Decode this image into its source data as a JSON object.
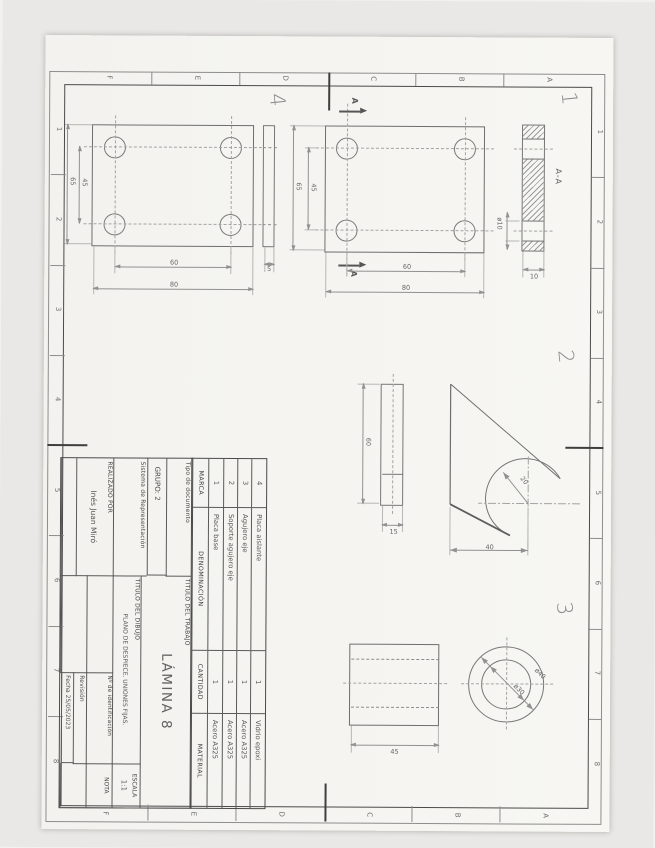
{
  "sheet": {
    "grid": {
      "numbers": [
        "1",
        "2",
        "3",
        "4",
        "5",
        "6",
        "7",
        "8"
      ],
      "letters": [
        "A",
        "B",
        "C",
        "D",
        "E",
        "F"
      ]
    }
  },
  "views": {
    "part1": {
      "label": "1",
      "section_title": "A-A",
      "cut_letter": "A",
      "dim_hole": "ø10",
      "dim_thickness": "10",
      "dim_holes_v": "60",
      "dim_height": "80",
      "dim_holes_h": "45",
      "dim_width": "65"
    },
    "part2": {
      "label": "2",
      "dim_radius": "20",
      "dim_center_height": "40",
      "dim_length": "60",
      "dim_thickness": "15"
    },
    "part3": {
      "label": "3",
      "dim_outer": "ø40",
      "dim_inner": "ø30",
      "dim_length": "45"
    },
    "part4": {
      "label": "4",
      "dim_thickness": "5",
      "dim_holes_v": "60",
      "dim_height": "80",
      "dim_holes_h": "45",
      "dim_width": "65"
    }
  },
  "parts_table": {
    "headers": {
      "marca": "MARCA",
      "denominacion": "DENOMINACIÓN",
      "cantidad": "CANTIDAD",
      "material": "MATERIAL"
    },
    "rows": [
      {
        "marca": "4",
        "denominacion": "Placa aislante",
        "cantidad": "1",
        "material": "Vidrio epoxi"
      },
      {
        "marca": "3",
        "denominacion": "Agujero eje",
        "cantidad": "1",
        "material": "Acero A325"
      },
      {
        "marca": "2",
        "denominacion": "Soporte agujero eje",
        "cantidad": "1",
        "material": "Acero A325"
      },
      {
        "marca": "1",
        "denominacion": "Placa base",
        "cantidad": "1",
        "material": "Acero A325"
      }
    ]
  },
  "title_block": {
    "tipo_documento_label": "Tipo de documento",
    "grupo_label": "GRUPO:",
    "grupo_value": "2",
    "sistema_label": "Sistema de Representación",
    "realizado_label": "REALIZADO POR",
    "realizado_value": "Inés Juan Miró",
    "titulo_trabajo_label": "TITULO DEL TRABAJO",
    "titulo_trabajo_value": "LÁMINA 8",
    "titulo_dibujo_label": "TITULO DEL DIBUJO",
    "titulo_dibujo_value": "PLANO DE DESPIECE. UNIONES FIJAS.",
    "num_id_label": "Nº de identificación",
    "escala_label": "ESCALA",
    "escala_value": "1:1",
    "nota_label": "NOTA",
    "revision_label": "Revisión",
    "fecha_label": "Fecha",
    "fecha_value": "25/05/2023"
  },
  "colors": {
    "paper": "#f6f5f1",
    "scanner_bg": "#e9e8e6",
    "frame_line": "#4a4a4a",
    "pencil_line": "#7a7a7a",
    "dim_line": "#919191",
    "text": "#5a5a5a"
  }
}
